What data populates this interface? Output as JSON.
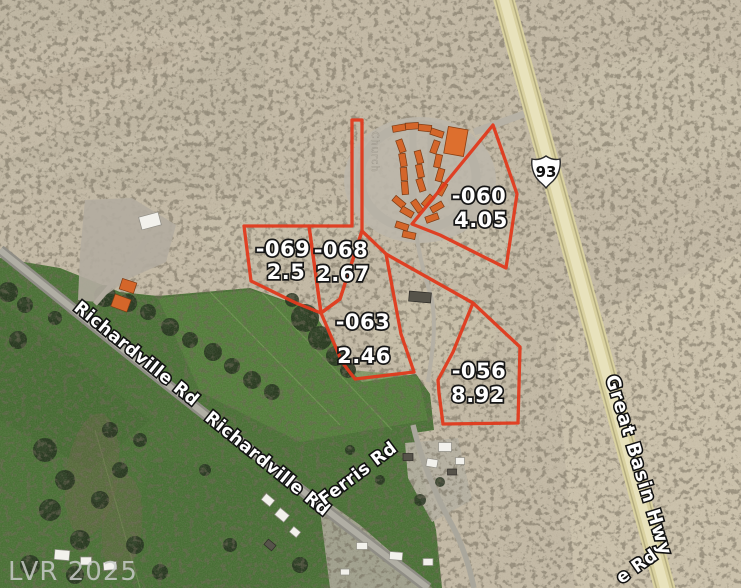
{
  "map": {
    "watermark": "LVR 2025",
    "highway": {
      "shield_number": "93",
      "name": "Great Basin Hwy"
    },
    "road_labels": {
      "richardville": "Richardville Rd",
      "ferris": "Ferris Rd",
      "great_basin": "Great Basin Hwy",
      "partial_bottom_right": "e Rd",
      "faint_minor": "Church"
    },
    "colors": {
      "parcel_outline": "#e13a1d",
      "parcel_label_fill": "#ffffff",
      "desert": "#c1b7a3",
      "field_green": "#4e7539",
      "highway": "#d9d1a0",
      "trailer_orange": "#d4662a",
      "watermark_gray": "#c7cbc7"
    }
  },
  "parcels": [
    {
      "id": "-069",
      "acres": "2.5"
    },
    {
      "id": "-068",
      "acres": "2.67"
    },
    {
      "id": "-063",
      "acres": "2.46"
    },
    {
      "id": "-060",
      "acres": "4.05"
    },
    {
      "id": "-056",
      "acres": "8.92"
    }
  ]
}
